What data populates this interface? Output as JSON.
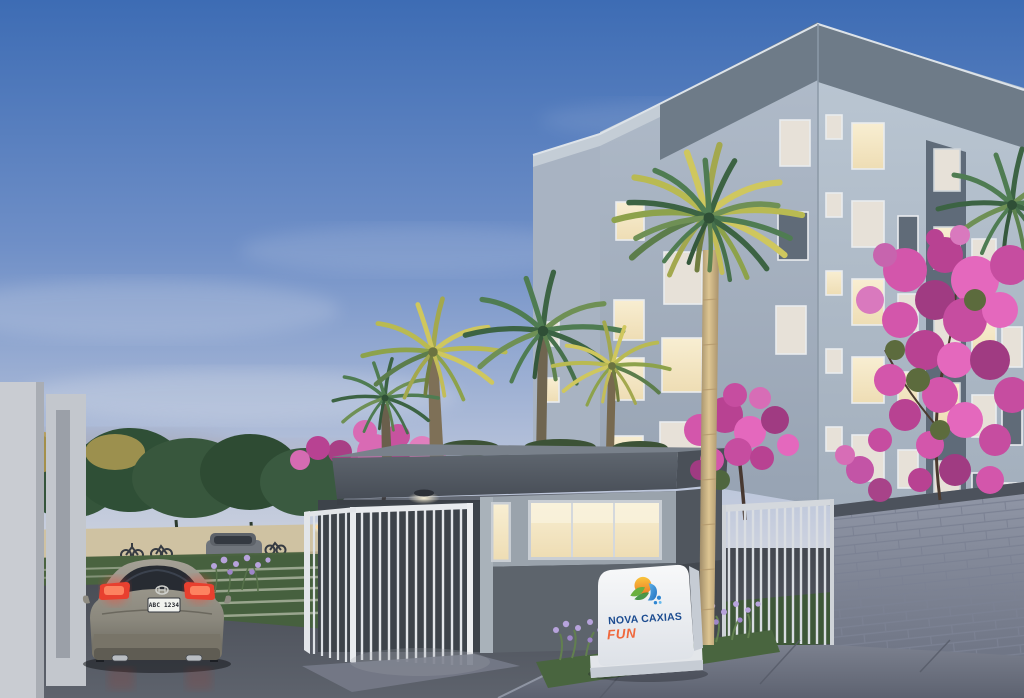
{
  "meta": {
    "type": "architectural-dusk-rendering",
    "subject": "Residential condominium entrance at dusk",
    "width_px": 1024,
    "height_px": 698
  },
  "sign": {
    "brand_line": "NOVA CAXIAS",
    "sub_line": "FUN",
    "logo": "sun-leaves-water-splash-logo"
  },
  "vehicle": {
    "license_plate": "ABC 1234",
    "type": "sedan-rear-view-taillights-lit"
  },
  "scene": {
    "elements": [
      "five-story apartment building with lit windows",
      "entrance gatehouse with glowing window and downlight",
      "white vertical-bar pedestrian gates",
      "white picket fence and gray concrete-block wall",
      "palm trees",
      "pink flowering trees",
      "green perimeter trees over beige wall",
      "monument brand sign",
      "gray sedan leaving on driveway",
      "parked wagon and bicycle racks",
      "lavender flower beds and grass",
      "asphalt road and concrete sidewalk",
      "gradient dusk sky with soft clouds"
    ]
  },
  "colors": {
    "sky_top": "#3d6cb4",
    "sky_mid": "#8aa3cf",
    "sky_horizon": "#dcdde2",
    "building_face_left": "#a7b3c2",
    "building_face_right": "#b2bfcb",
    "building_parapet": "#6e7b88",
    "window_lit": "#f6e9c9",
    "window_pale": "#e7e1d8",
    "roof_fascia": "#575e68",
    "wall_upper": "#9aa3ac",
    "wall_lower": "#5d646c",
    "fence_white": "#dde1e5",
    "block_wall": "#8d93a4",
    "road": "#4a4e58",
    "sidewalk": "#6e7382",
    "grass": "#49653f",
    "perimeter_wall": "#cfc2a2",
    "pink_tree": "#d356ab",
    "palm_green": "#4f7c52",
    "palm_yellow": "#b9ba52",
    "car_body": "#94907f",
    "taillight": "#ff4530",
    "sign_bg": "#f4f5f6",
    "brand_blue": "#1c4c90",
    "brand_orange": "#f0683c",
    "logo_orange": "#f49a2a",
    "logo_green": "#58a23f",
    "logo_blue": "#2f86d2"
  }
}
